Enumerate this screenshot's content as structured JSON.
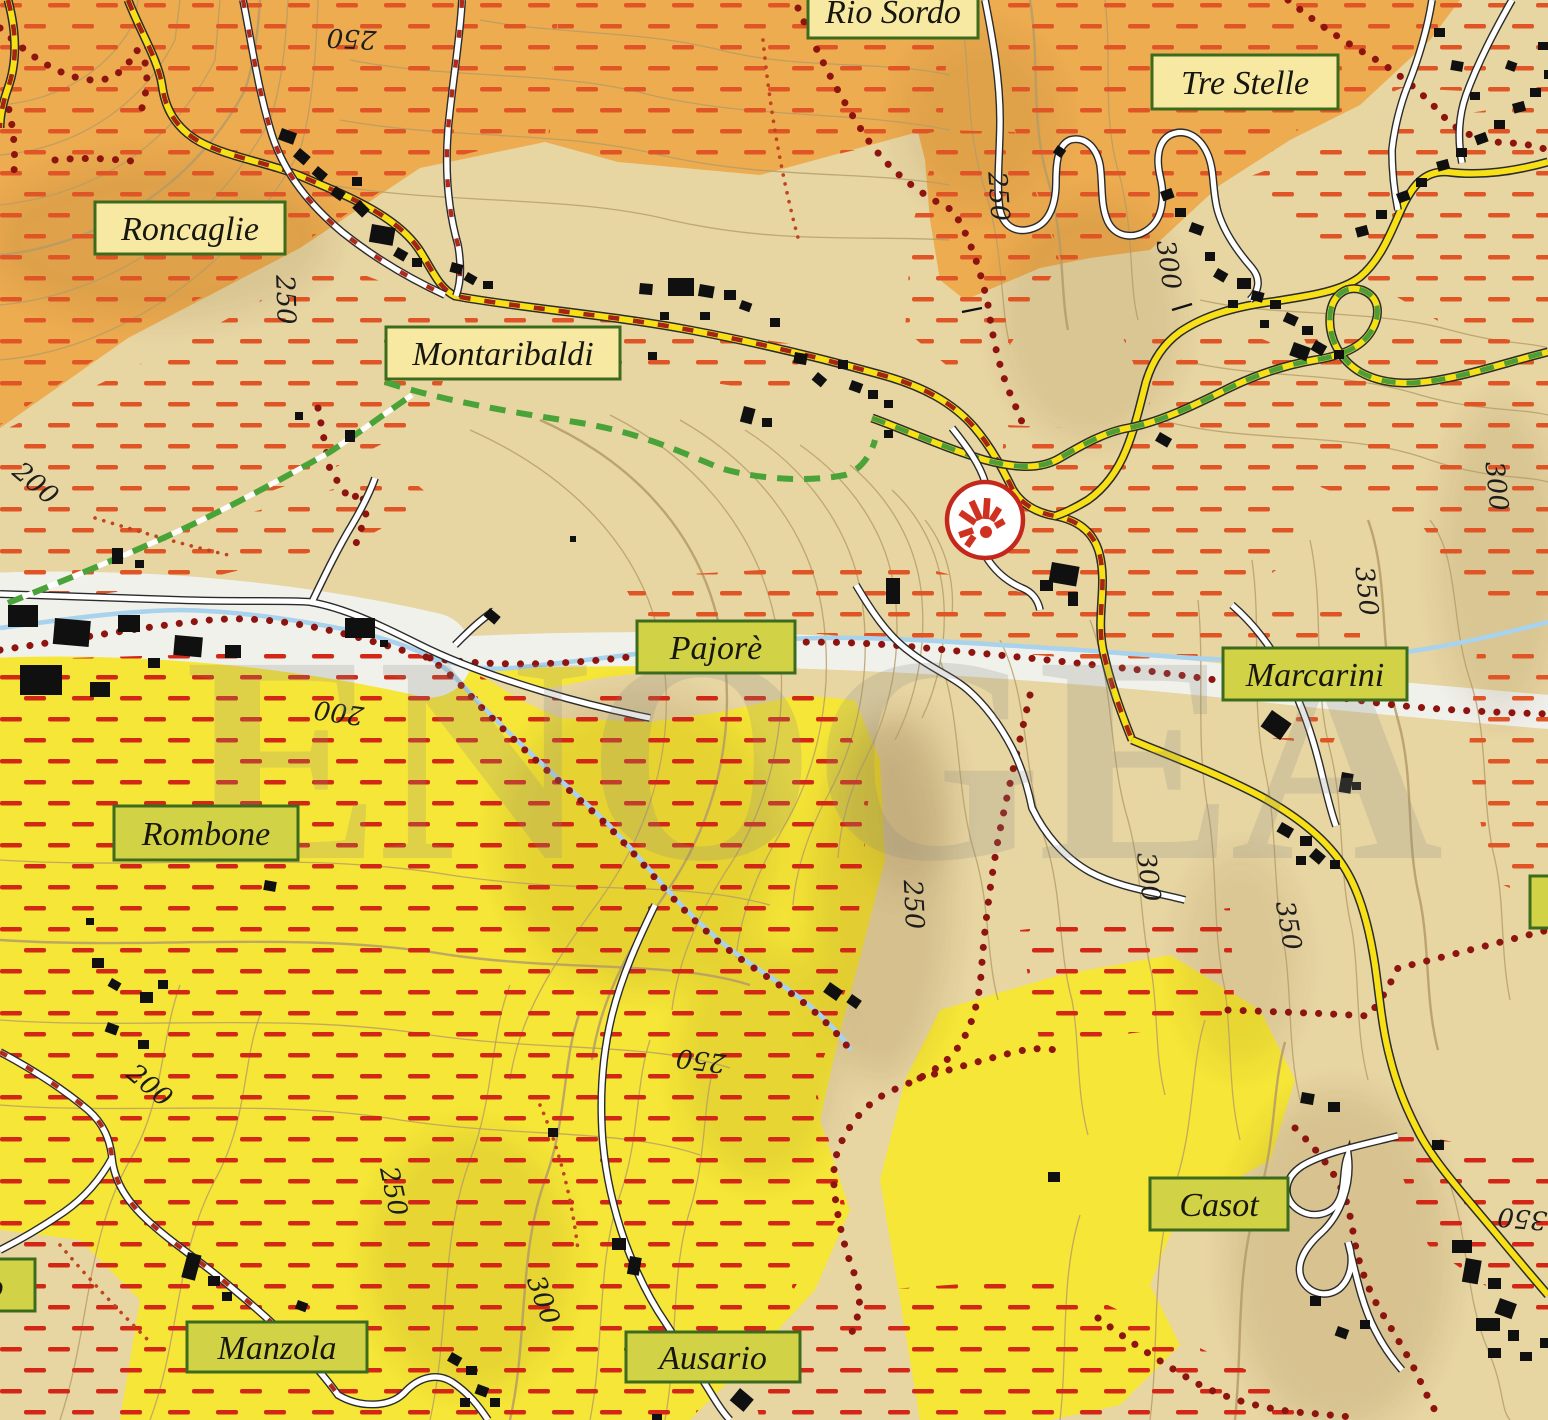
{
  "labels": {
    "rio_sordo": {
      "text": "Rio Sordo",
      "type": "village"
    },
    "tre_stelle": {
      "text": "Tre Stelle",
      "type": "village"
    },
    "roncaglie": {
      "text": "Roncaglie",
      "type": "village"
    },
    "montaribaldi": {
      "text": "Montaribaldi",
      "type": "village"
    },
    "pajore": {
      "text": "Pajorè",
      "type": "cru"
    },
    "marcarini": {
      "text": "Marcarini",
      "type": "cru"
    },
    "rombone": {
      "text": "Rombone",
      "type": "cru"
    },
    "casot": {
      "text": "Casot",
      "type": "cru"
    },
    "manzola": {
      "text": "Manzola",
      "type": "cru"
    },
    "ausario": {
      "text": "Ausario",
      "type": "cru"
    },
    "cut_left": {
      "text": "o",
      "type": "cru"
    },
    "cut_right": {
      "text": "",
      "type": "cru"
    }
  },
  "contours": [
    {
      "value": "250"
    },
    {
      "value": "250"
    },
    {
      "value": "200"
    },
    {
      "value": "250"
    },
    {
      "value": "300"
    },
    {
      "value": "300"
    },
    {
      "value": "350"
    },
    {
      "value": "200"
    },
    {
      "value": "200"
    },
    {
      "value": "250"
    },
    {
      "value": "300"
    },
    {
      "value": "350"
    },
    {
      "value": "250"
    },
    {
      "value": "250"
    },
    {
      "value": "300"
    },
    {
      "value": "350"
    }
  ],
  "watermark": {
    "text": "ENOGEA"
  },
  "symbols": [
    {
      "name": "winery-sun-marker"
    }
  ],
  "colors": {
    "label_border_green": "#3c6b1e",
    "village_label_bg": "#f8e9a2",
    "cru_label_bg": "#d2d246",
    "orange_zone": "#edac50",
    "tan_zone": "#e7d5a2",
    "yellow_zone": "#f6e637",
    "valley_white": "#f1f1ec",
    "road_yellow": "#f8e017",
    "road_red_dash": "#a62317",
    "road_green_dash": "#4c9e38",
    "trail_green": "#4aa339",
    "boundary_red": "#8e1410",
    "hatch_orange": "#df5526",
    "hatch_red": "#d22716",
    "stream_blue": "#a9d2ec",
    "contour_brown": "#b49b67",
    "building_black": "#101010",
    "marker_red": "#c4271c",
    "watermark_gray": "#8a8a85"
  }
}
